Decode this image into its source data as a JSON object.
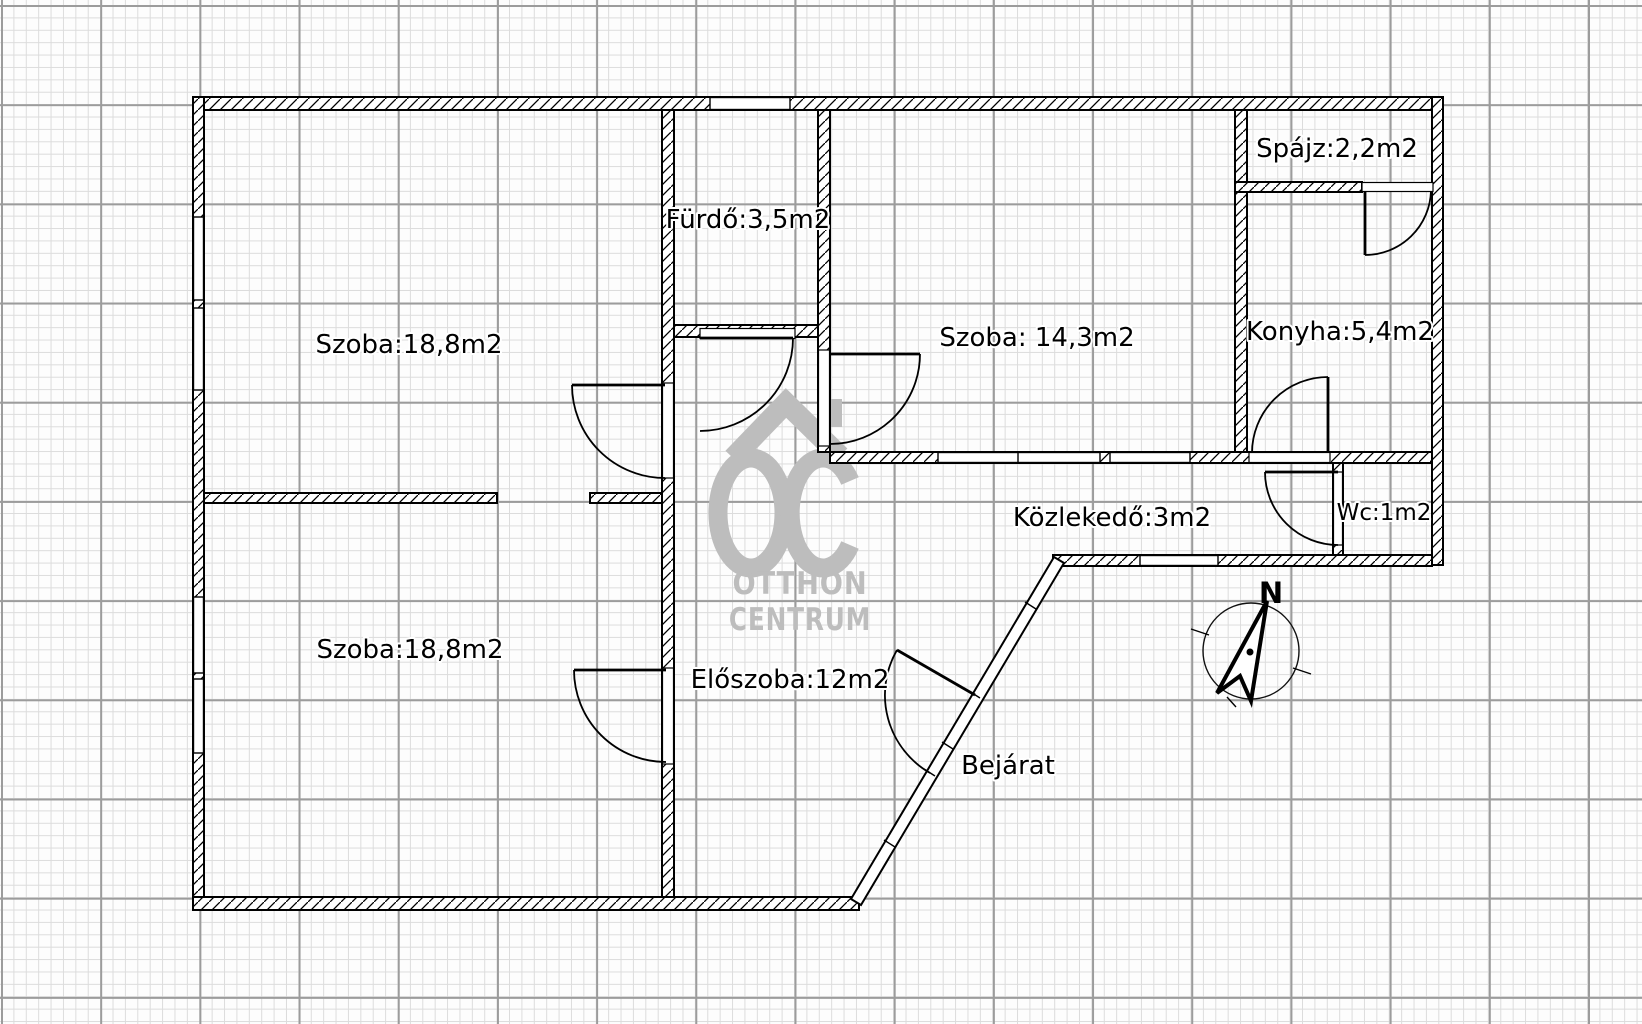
{
  "plan": {
    "rooms": [
      {
        "id": "szoba-top-left",
        "label": "Szoba:18,8m2"
      },
      {
        "id": "furdo",
        "label": "Fürdő:3,5m2"
      },
      {
        "id": "szoba-middle",
        "label": "Szoba: 14,3m2"
      },
      {
        "id": "spajz",
        "label": "Spájz:2,2m2"
      },
      {
        "id": "konyha",
        "label": "Konyha:5,4m2"
      },
      {
        "id": "wc",
        "label": "Wc:1m2"
      },
      {
        "id": "kozlekedo",
        "label": "Közlekedő:3m2"
      },
      {
        "id": "szoba-bottom-left",
        "label": "Szoba:18,8m2"
      },
      {
        "id": "eloszoba",
        "label": "Előszoba:12m2"
      },
      {
        "id": "bejarat",
        "label": "Bejárat"
      }
    ],
    "compass": {
      "north_label": "N"
    },
    "watermark": {
      "brand_initials": "OC",
      "line1": "OTTHON",
      "line2": "CENTRUM"
    },
    "colors": {
      "wall": "#000000",
      "watermark_gray": "#bdbdbd",
      "grid_minor": "#dcdcdc",
      "grid_major": "#9c9c9c"
    }
  }
}
